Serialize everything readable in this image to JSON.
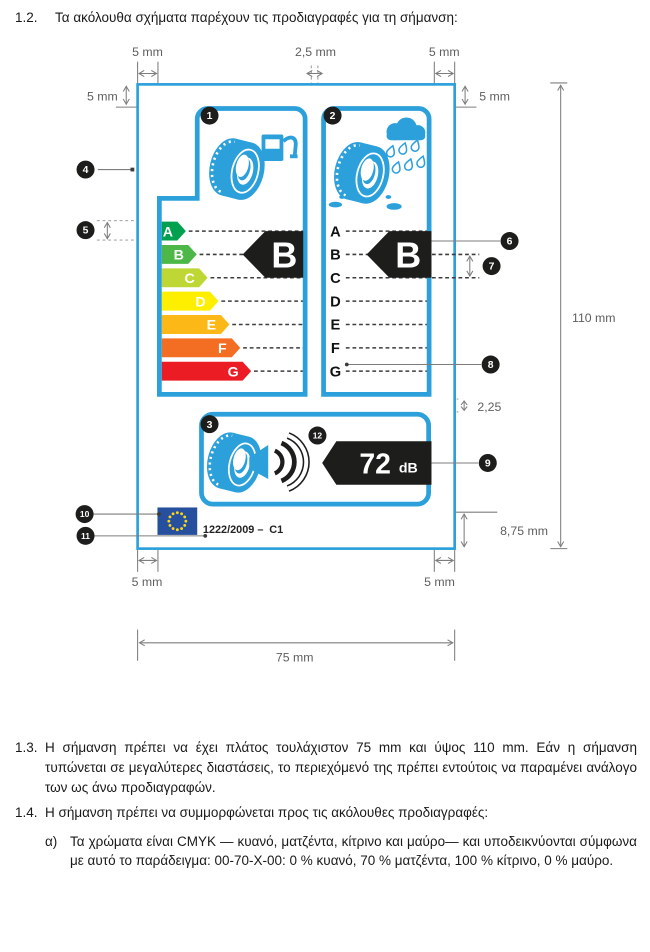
{
  "document": {
    "section_1_2": {
      "number": "1.2.",
      "text": "Τα ακόλουθα σχήματα παρέχουν τις προδιαγραφές για τη σήμανση:"
    },
    "section_1_3": {
      "number": "1.3.",
      "text": "Η σήμανση πρέπει να έχει πλάτος τουλάχιστον 75 mm και ύψος 110 mm. Εάν η σήμανση τυπώνεται σε μεγαλύτερες διαστάσεις, το περιεχόμενό της πρέπει εντούτοις να παραμένει ανάλογο των ως άνω προδιαγραφών."
    },
    "section_1_4": {
      "number": "1.4.",
      "text": "Η σήμανση πρέπει να συμμορφώνεται προς τις ακόλουθες προδιαγραφές:"
    },
    "item_a": {
      "number": "α)",
      "text": "Τα χρώματα είναι CMYK — κυανό, ματζέντα, κίτρινο και μαύρο— και υποδεικνύονται σύμφωνα με αυτό το παράδειγμα: 00-70-X-00: 0 % κυανό, 70 % ματζέντα, 100 % κίτρινο, 0 % μαύρο."
    }
  },
  "label": {
    "grades": [
      {
        "letter": "A",
        "color": "#00A14E"
      },
      {
        "letter": "B",
        "color": "#4DB848"
      },
      {
        "letter": "C",
        "color": "#BFD734"
      },
      {
        "letter": "D",
        "color": "#FEEF00"
      },
      {
        "letter": "E",
        "color": "#FBB817"
      },
      {
        "letter": "F",
        "color": "#F36E23"
      },
      {
        "letter": "G",
        "color": "#EB1C24"
      }
    ],
    "fuel_efficiency_class": "B",
    "wet_grip_class": "B",
    "noise_value": "72",
    "noise_unit": "dB",
    "regulation": "1222/2009 –",
    "regulation_part": "C1",
    "markers": [
      "1",
      "2",
      "3",
      "4",
      "5",
      "6",
      "7",
      "8",
      "9",
      "10",
      "11",
      "12"
    ],
    "colors": {
      "frame_blue": "#2CA0DB",
      "pictogram_blue": "#2CA0DB",
      "black": "#1D1D1B",
      "eu_flag_blue": "#26509D",
      "eu_star_yellow": "#FFD617"
    }
  },
  "dimensions": {
    "margin_top_left": "5 mm",
    "gap_center": "2,5 mm",
    "margin_top_right": "5 mm",
    "inner_top_left": "5 mm",
    "inner_top_right": "5 mm",
    "total_height": "110 mm",
    "section_gap": "2,25",
    "bottom_band": "8,75 mm",
    "margin_bottom_left": "5 mm",
    "margin_bottom_right": "5 mm",
    "total_width": "75 mm"
  }
}
